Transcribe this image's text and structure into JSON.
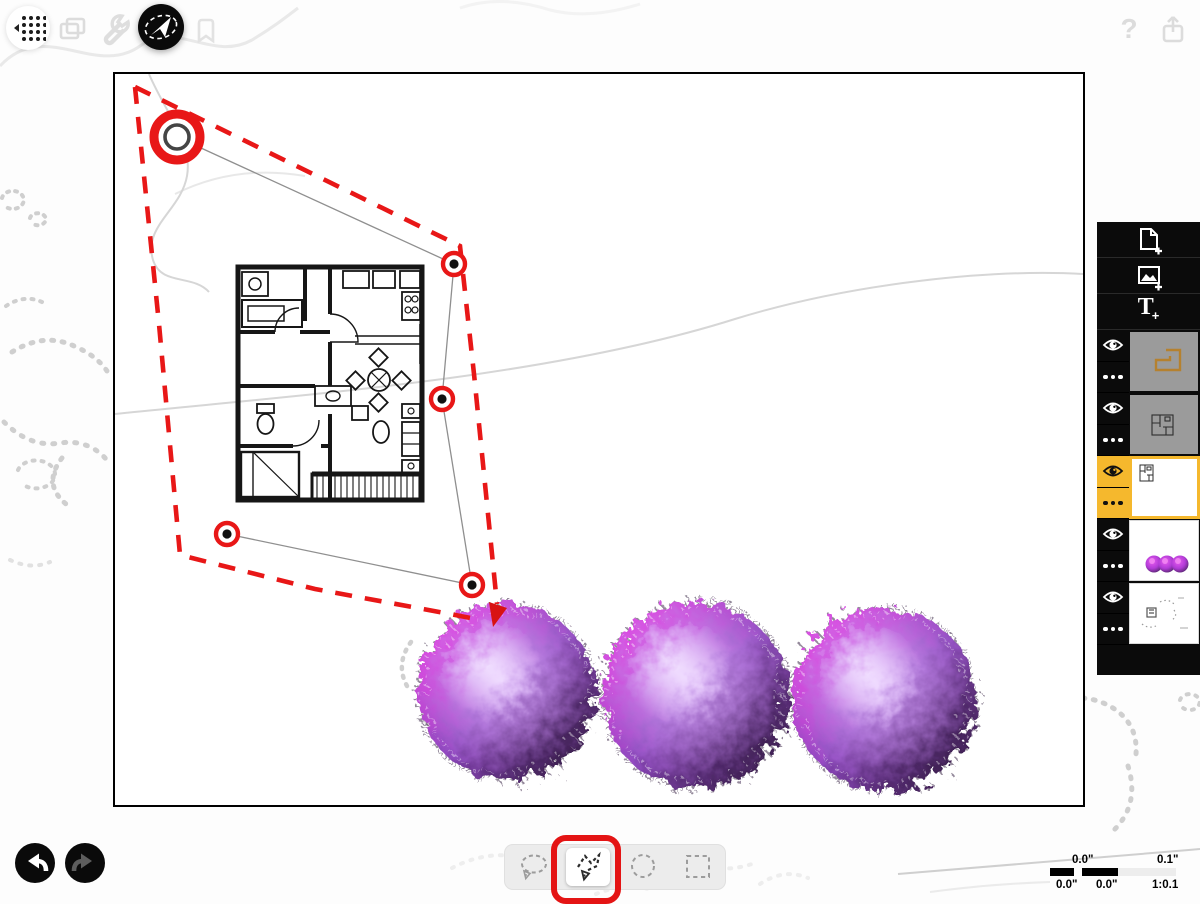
{
  "app": {
    "type": "sketch-drawing-app",
    "top_toolbar": {
      "tools": [
        {
          "name": "grid-menu",
          "icon": "dot-grid-icon",
          "active": false
        },
        {
          "name": "pages",
          "icon": "stacked-pages-icon",
          "active": false
        },
        {
          "name": "settings",
          "icon": "wrench-icon",
          "active": false
        },
        {
          "name": "select",
          "icon": "lasso-arrow-icon",
          "active": true
        },
        {
          "name": "mask",
          "icon": "bookmark-icon",
          "active": false
        }
      ],
      "help_label": "?",
      "share_icon": "share-icon"
    },
    "layers_panel": {
      "add_buttons": [
        {
          "name": "add-page",
          "icon": "document-plus-icon"
        },
        {
          "name": "add-image",
          "icon": "image-plus-icon"
        },
        {
          "name": "add-text",
          "icon": "text-plus-icon"
        }
      ],
      "text_tool_label": "T",
      "plus_label": "+",
      "selected_color": "#F5B82D",
      "layers": [
        {
          "name": "orange-outline-sketch",
          "visible": true,
          "selected": false,
          "thumb": "orange outline shape on gray"
        },
        {
          "name": "floor-plan-dimmed",
          "visible": true,
          "selected": false,
          "thumb": "small floor plan on gray"
        },
        {
          "name": "floor-plan",
          "visible": true,
          "selected": true,
          "thumb": "floor plan on white"
        },
        {
          "name": "trees",
          "visible": true,
          "selected": false,
          "thumb": "three purple trees"
        },
        {
          "name": "landscape-sketch",
          "visible": true,
          "selected": false,
          "thumb": "gray pencil sketch"
        }
      ]
    },
    "selection_toolbar": {
      "tools": [
        "freehand-lasso",
        "polygon-lasso",
        "ellipse-select",
        "rect-select"
      ],
      "selected": "polygon-lasso",
      "annotation_color": "#E41414"
    },
    "history": {
      "undo_enabled": true,
      "redo_enabled": false
    },
    "scale_bar": {
      "top_left": "0.0\"",
      "top_right": "0.1\"",
      "bottom_left": "0.0\"",
      "bottom_mid": "0.0\"",
      "ratio": "1:0.1"
    },
    "selection": {
      "marquee_color": "#E81717",
      "vertex_count": 5,
      "style": "red dashed polygon with circled vertices and arrow head"
    },
    "colors": {
      "accent_red": "#E81717",
      "layer_selected_yellow": "#F5B82D",
      "tree_magenta": "#FB1FE4",
      "tree_dark_purple": "#1F1228",
      "tree_highlight": "#ECD6FF",
      "sketch_gray": "#C9C9C9"
    }
  }
}
